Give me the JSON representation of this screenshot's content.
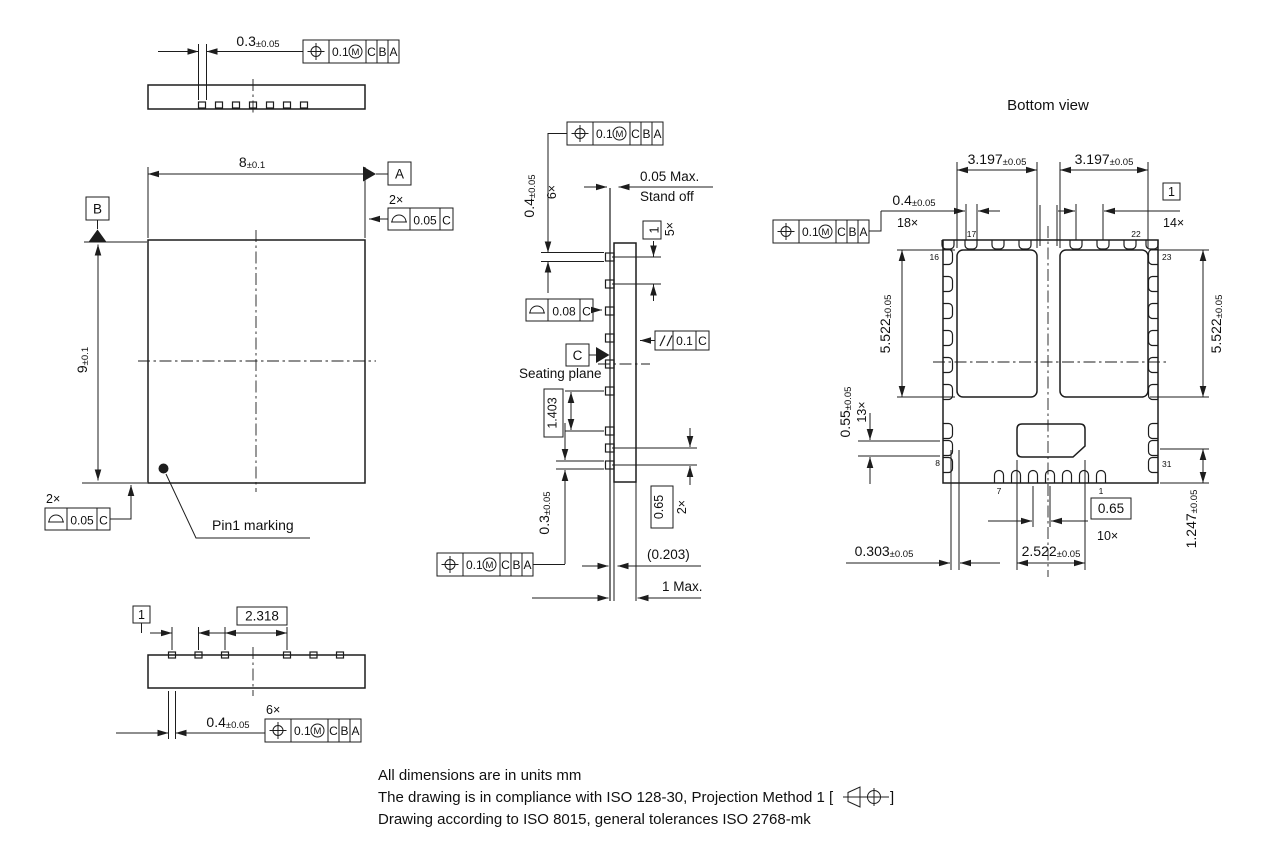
{
  "drawing": {
    "units_note": "All dimensions are in units mm",
    "compliance_note_prefix": "The drawing is in compliance with ISO 128-30, Projection Method 1 [",
    "compliance_note_suffix": "]",
    "tolerance_note": "Drawing according to ISO 8015, general tolerances ISO 2768-mk"
  },
  "datums": {
    "a": "A",
    "b": "B",
    "c": "C"
  },
  "fcf_position": {
    "tol": "0.1",
    "modifier": "M",
    "datum1": "C",
    "datum2": "B",
    "datum3": "A"
  },
  "fcf_profile_005": {
    "tol": "0.05",
    "datum": "C"
  },
  "fcf_profile_008": {
    "tol": "0.08",
    "datum": "C"
  },
  "fcf_parallel": {
    "tol": "0.1",
    "datum": "C"
  },
  "top_strip": {
    "lead_width": {
      "val": "0.3",
      "tol": "±0.05"
    }
  },
  "top_view": {
    "body_width": {
      "val": "8",
      "tol": "±0.1"
    },
    "body_height": {
      "val": "9",
      "tol": "±0.1"
    },
    "count_2x": "2×",
    "count_2x_bottom": "2×",
    "pin1_label": "Pin1 marking"
  },
  "bottom_strip": {
    "pitch": "1",
    "pitch_wide": "2.318",
    "lead_width": {
      "val": "0.4",
      "tol": "±0.05"
    },
    "count_6x": "6×"
  },
  "side_view": {
    "lead_width": {
      "val": "0.4",
      "tol": "±0.05"
    },
    "count_6x": "6×",
    "standoff_line1": "0.05 Max.",
    "standoff_line2": "Stand off",
    "pitch": "1",
    "count_5x": "5×",
    "seating_plane": "Seating plane",
    "pitch_mid": "1.403",
    "lead_width_bottom": {
      "val": "0.3",
      "tol": "±0.05"
    },
    "pitch_fine": "0.65",
    "count_2x": "2×",
    "lead_protrusion": "(0.203)",
    "max_height": "1 Max."
  },
  "bottom_view": {
    "title": "Bottom view",
    "pad_width_left": {
      "val": "3.197",
      "tol": "±0.05"
    },
    "pad_width_right": {
      "val": "3.197",
      "tol": "±0.05"
    },
    "lead_width": {
      "val": "0.4",
      "tol": "±0.05"
    },
    "count_18x": "18×",
    "pitch": "1",
    "count_14x": "14×",
    "pad_height_left": {
      "val": "5.522",
      "tol": "±0.05"
    },
    "pad_height_right": {
      "val": "5.522",
      "tol": "±0.05"
    },
    "lead_width_fine": {
      "val": "0.55",
      "tol": "±0.05"
    },
    "count_13x": "13×",
    "pad_offset": {
      "val": "1.247",
      "tol": "±0.05"
    },
    "edge_offset": {
      "val": "0.303",
      "tol": "±0.05"
    },
    "pad_width_bottom": {
      "val": "2.522",
      "tol": "±0.05"
    },
    "pitch_fine": "0.65",
    "count_10x": "10×",
    "pins": {
      "p1": "1",
      "p7": "7",
      "p8": "8",
      "p16": "16",
      "p17": "17",
      "p22": "22",
      "p23": "23",
      "p31": "31"
    }
  }
}
